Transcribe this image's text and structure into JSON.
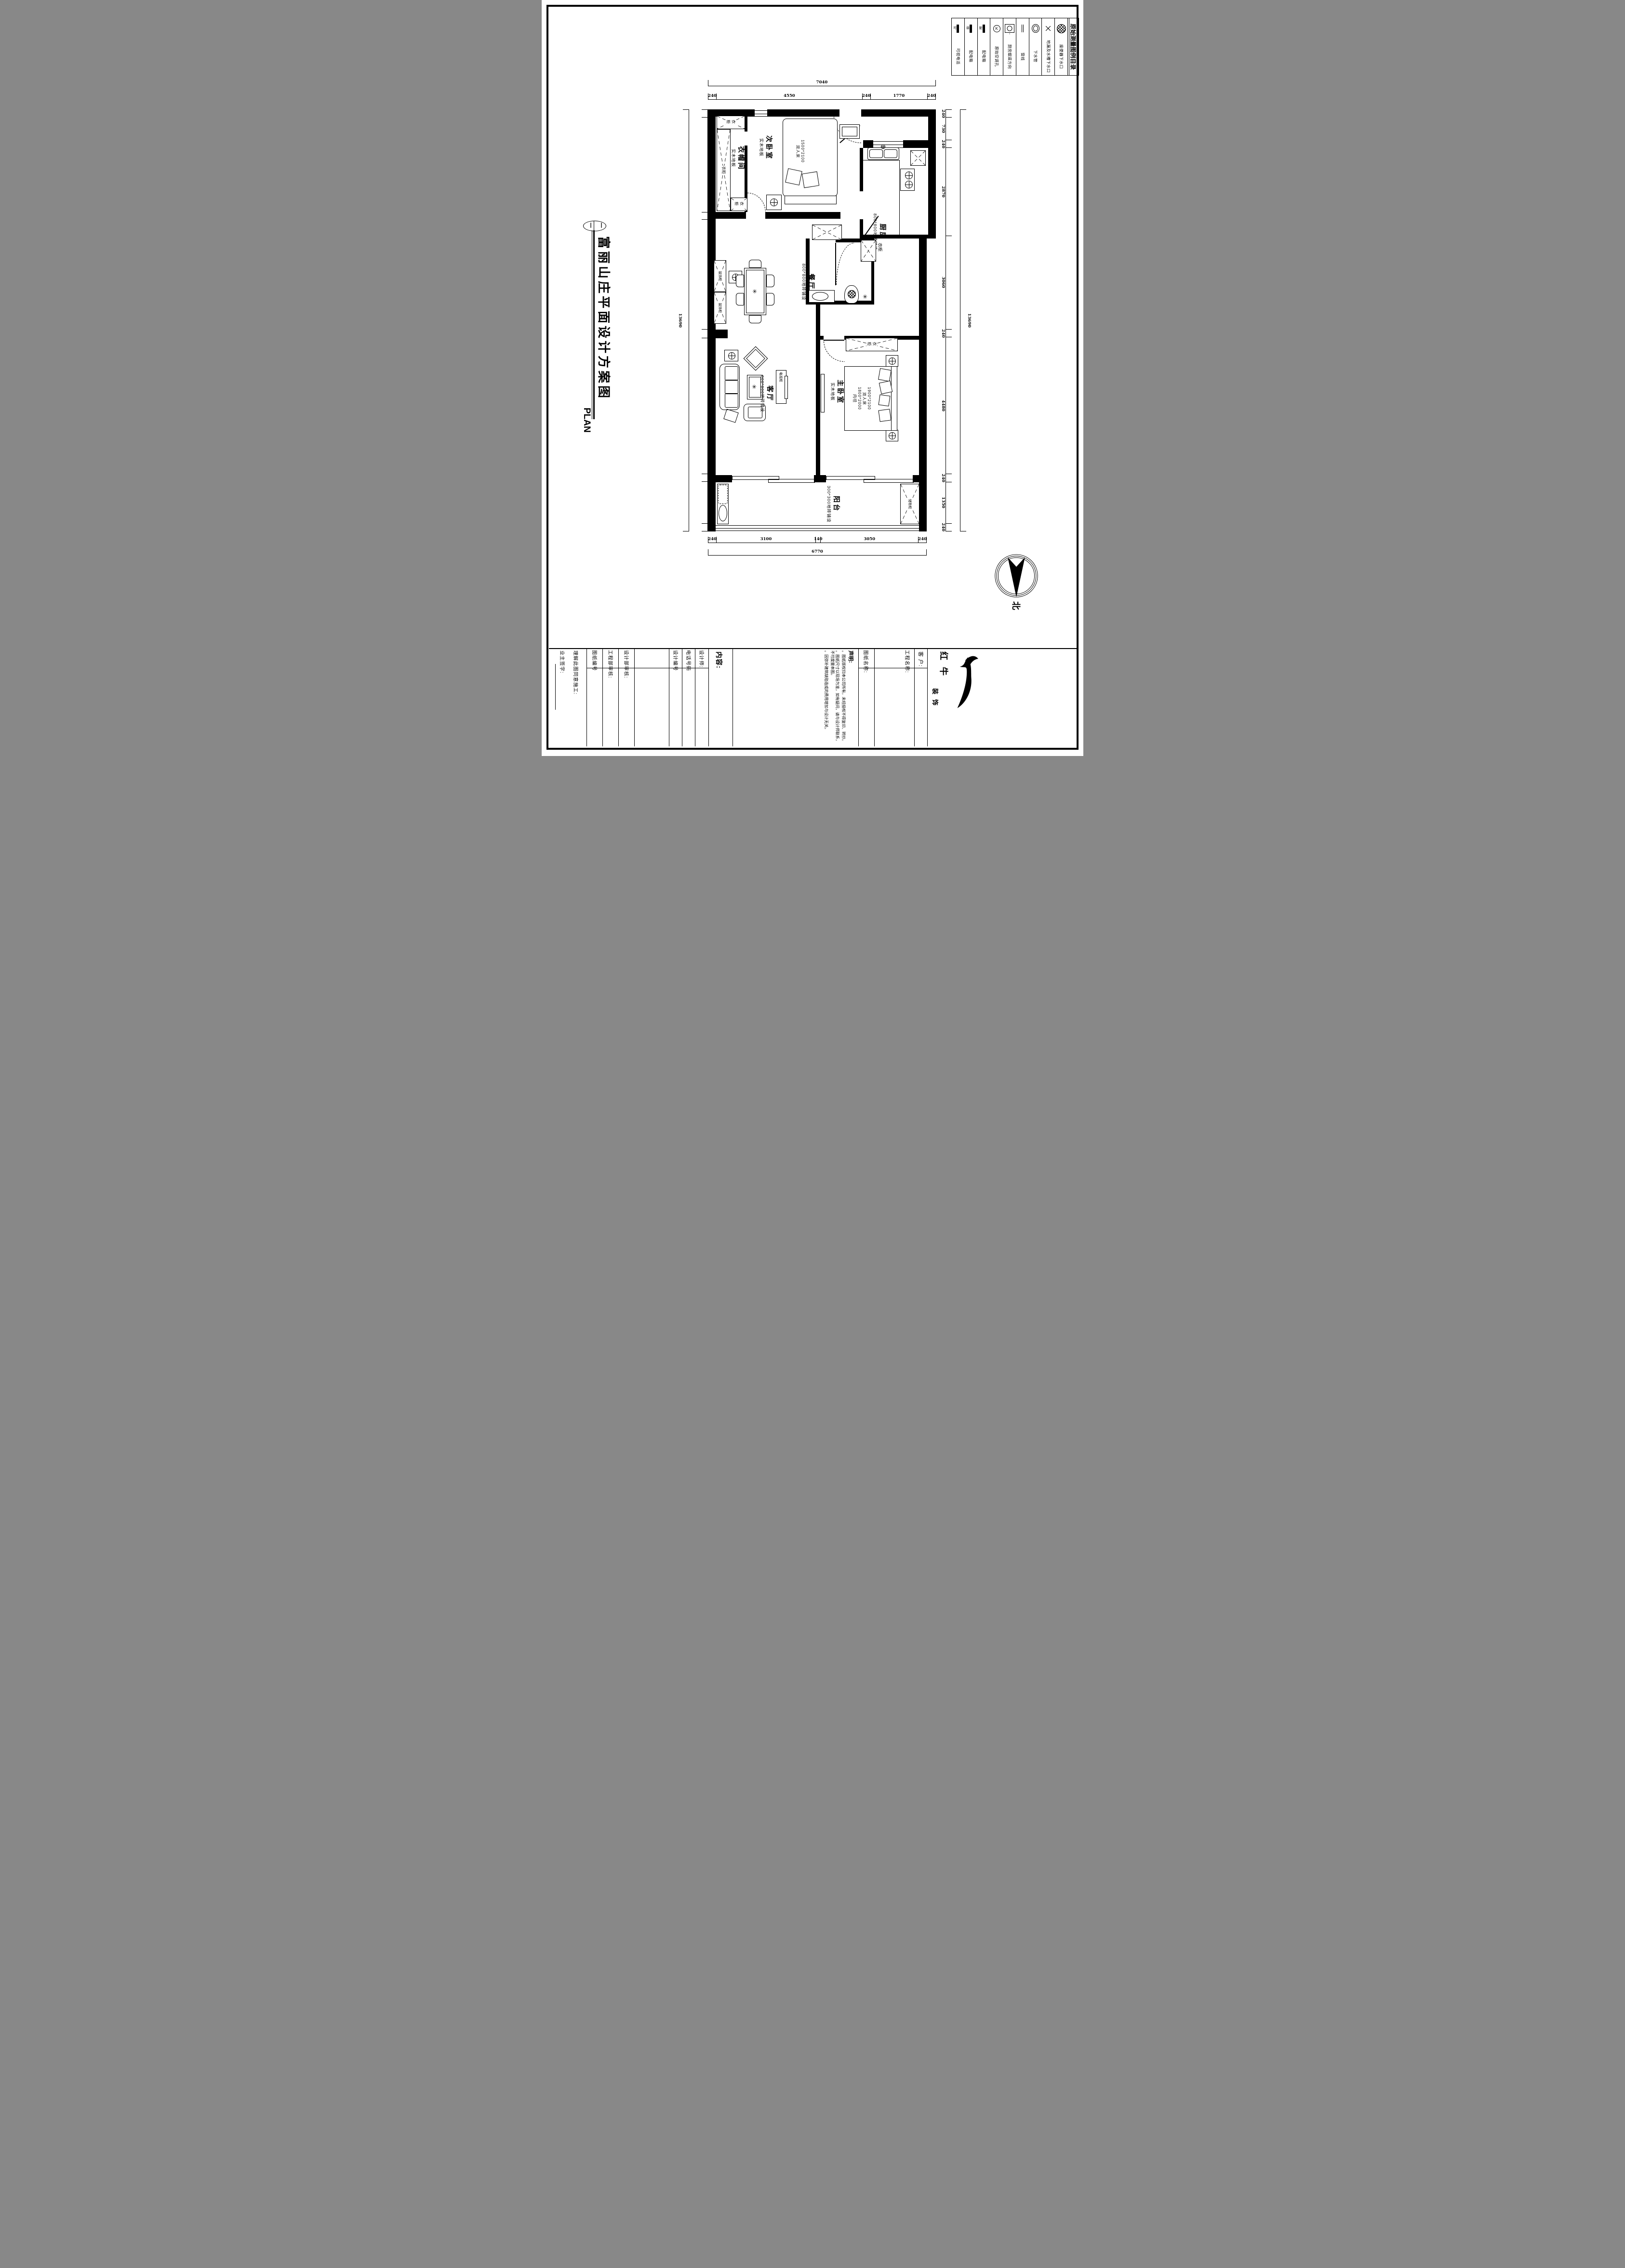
{
  "legend": {
    "title": "原始测量图例目录",
    "items": [
      {
        "icon": "toilet-drain",
        "label": "座便器下水口"
      },
      {
        "icon": "floor-sink-drain",
        "label": "地漏及水槽下水口"
      },
      {
        "icon": "drain-pipe",
        "label": "下水管"
      },
      {
        "icon": "window-line",
        "label": "窗线"
      },
      {
        "icon": "kitchen-flue-direction",
        "label": "厨房烟道方向"
      },
      {
        "icon": "original-ac-hole",
        "label": "原始空调孔",
        "symbol": "K"
      },
      {
        "icon": "power-box",
        "label": "配电箱",
        "symbol": "配"
      },
      {
        "icon": "weak-power-box",
        "label": "配电箱",
        "symbol": "弱"
      },
      {
        "icon": "video-phone",
        "label": "可视电话",
        "symbol": "可"
      }
    ]
  },
  "sheet_title": {
    "bubble": [
      "一",
      "一"
    ],
    "name": "富丽山庄平面设计方案图",
    "subtitle": "PLAN"
  },
  "north": {
    "label": "北"
  },
  "rooms": {
    "cloakroom": {
      "name": "衣帽间",
      "floor": "实木地板"
    },
    "second_bedroom": {
      "name": "次卧室",
      "floor": "实木地板",
      "bed": [
        "1500*2100",
        "双人床"
      ]
    },
    "kitchen": {
      "name": "厨房",
      "floor": "800*800地砖铺设"
    },
    "dining": {
      "name": "餐厅",
      "floor": "800*800地砖铺设"
    },
    "living": {
      "name": "客厅",
      "floor": "800*800地砖铺设"
    },
    "master_bedroom": {
      "name": "主卧室",
      "floor": "实木地板",
      "bed": [
        "1900*2100",
        "双人床",
        "1800*2000",
        "内径"
      ]
    },
    "balcony": {
      "name": "阳台",
      "floor": "300*300地砖铺设"
    }
  },
  "furniture": {
    "wardrobe": "衣柜",
    "deco_cabinet": "装饰柜",
    "tv_cabinet": "电视柜",
    "storage_cabinet": "储物柜"
  },
  "dimensions": {
    "top": {
      "segments": [
        240,
        4550,
        240,
        1770,
        240
      ],
      "total": 7040
    },
    "bottom": {
      "segments": [
        240,
        3100,
        140,
        3050,
        240
      ],
      "total": 6770
    },
    "left": {
      "segments": [
        240,
        3090,
        220,
        3590,
        280,
        4440,
        240,
        1350,
        240
      ],
      "total": 13690
    },
    "right": {
      "segments": [
        240,
        730,
        240,
        2870,
        3060,
        240,
        4480,
        240,
        1350,
        240
      ],
      "total": 13690
    }
  },
  "titleblock": {
    "client": "客 户:",
    "project": "工程名称:",
    "drawing": "图纸名称:",
    "declaration": {
      "heading": "声明:",
      "bullets": [
        "。图纸版权归本公司所有，未经授权不得复印、转抄。",
        "。图纸尺寸以现场为准，如有疑问，请与设计师联系，不可度量本图。",
        "。因弥补建筑缺陷造成的费用增加与设计无关。"
      ]
    },
    "content": "内容:",
    "designer": "设计师:",
    "phone": "电话号码",
    "design_no": "设计编号",
    "design_review": "设计部审核:",
    "eng_review": "工程部审核:",
    "drawing_no": "图纸编号",
    "agree": "理解此图同意施工:",
    "owner_sign": "业主签字:",
    "logo": {
      "name1": "红牛",
      "name2": "装饰"
    }
  }
}
